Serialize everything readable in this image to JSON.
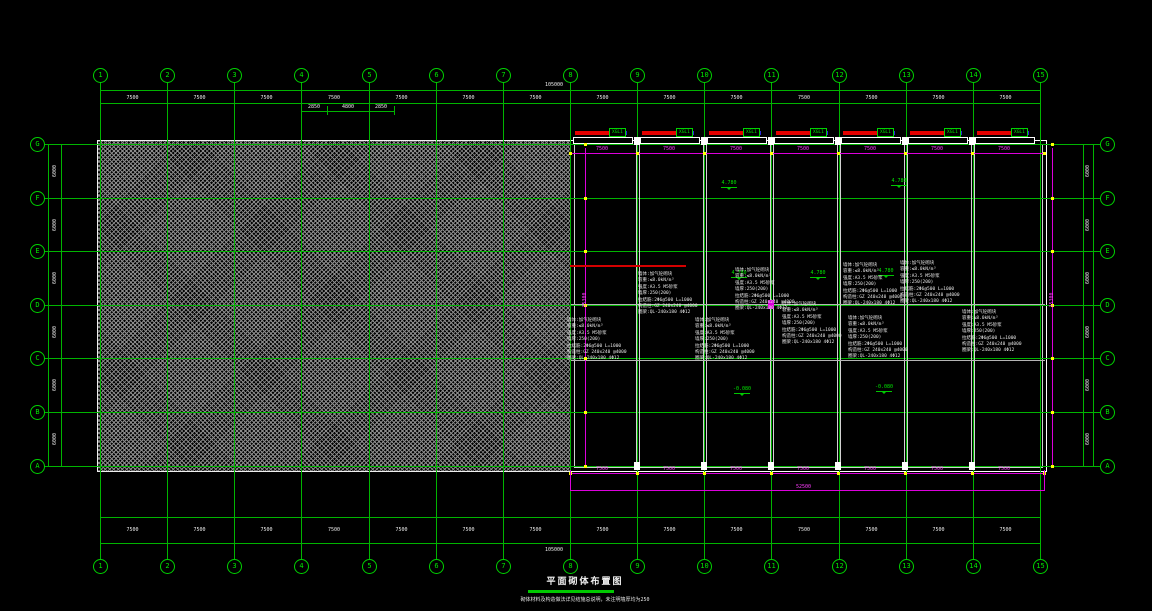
{
  "drawing": {
    "title": "平面砌体布置图",
    "note": "砌体材料及构造做法详见结施总说明，未注明墙厚均为250",
    "red_note": "JQL1 250x400 梁顶标高同墙顶 配筋详结施"
  },
  "axes": {
    "cols": [
      "1",
      "2",
      "3",
      "4",
      "5",
      "6",
      "7",
      "8",
      "9",
      "10",
      "11",
      "12",
      "13",
      "14",
      "15"
    ],
    "rows": [
      "G",
      "F",
      "E",
      "D",
      "C",
      "B",
      "A"
    ]
  },
  "dims": {
    "top_total": "105000",
    "top_bay": "7500",
    "sub_chain": [
      "2850",
      "4800",
      "2850"
    ],
    "bottom_total": "105000",
    "bottom_bay": "7500",
    "right_total": "52500",
    "right_bay": "7500",
    "inner_bay": "7500",
    "vert_bay": "6000",
    "vert_total": "35300"
  },
  "labels": {
    "xgl": "XGL1"
  },
  "elevations": [
    {
      "x": 714,
      "y": 180,
      "v": "4.780"
    },
    {
      "x": 884,
      "y": 178,
      "v": "4.780"
    },
    {
      "x": 724,
      "y": 270,
      "v": "4.780"
    },
    {
      "x": 803,
      "y": 270,
      "v": "4.780"
    },
    {
      "x": 871,
      "y": 268,
      "v": "4.780"
    },
    {
      "x": 727,
      "y": 386,
      "v": "-0.080"
    },
    {
      "x": 869,
      "y": 384,
      "v": "-0.080"
    }
  ],
  "spec_lines": [
    "墙体:加气砼砌块",
    "容重:≤8.0kN/m³",
    "强度:A3.5 M5砂浆",
    "墙厚:250(200)",
    "拉结筋:2Φ6@500 L=1000",
    "构造柱:GZ 240x240 @4000",
    "圈梁:QL-240x180 4Φ12"
  ],
  "spec_blocks": [
    {
      "x": 638,
      "y": 272
    },
    {
      "x": 735,
      "y": 268
    },
    {
      "x": 843,
      "y": 263
    },
    {
      "x": 900,
      "y": 261
    },
    {
      "x": 567,
      "y": 318
    },
    {
      "x": 695,
      "y": 318
    },
    {
      "x": 782,
      "y": 302
    },
    {
      "x": 848,
      "y": 316
    },
    {
      "x": 962,
      "y": 310
    }
  ],
  "colors": {
    "grid_green": "#00b400",
    "magenta": "#dc00dc",
    "red": "#d40000",
    "blue": "#2828dc",
    "yellow": "#ffff00",
    "white": "#ffffff"
  }
}
